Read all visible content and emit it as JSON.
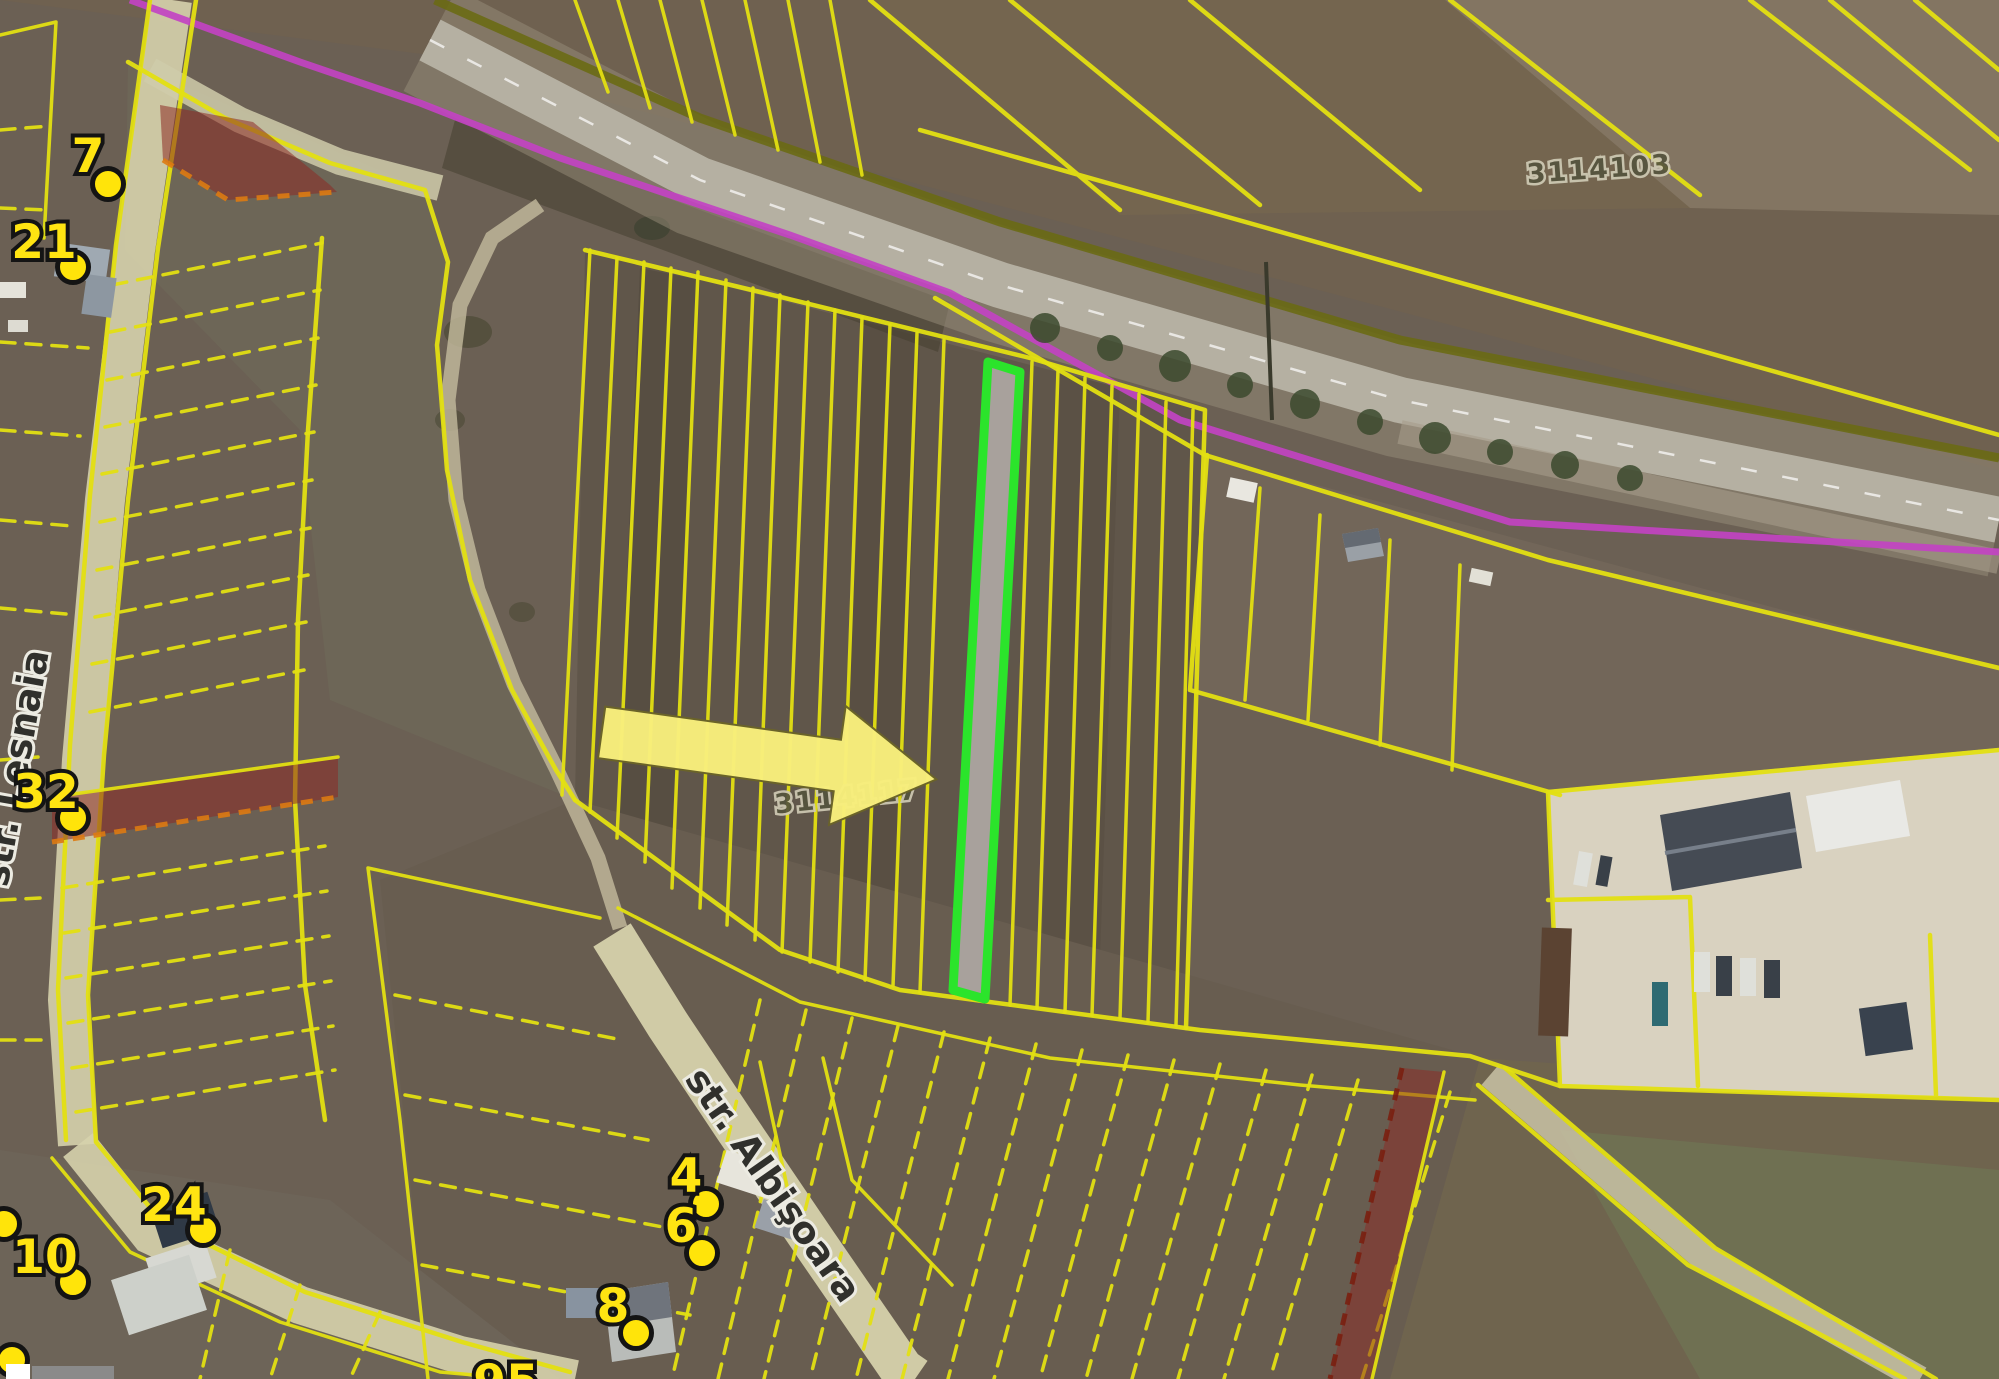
{
  "map": {
    "type": "satellite-cadastral-map",
    "parcel_labels": [
      {
        "text": "3114103",
        "x": 1600,
        "y": 178
      },
      {
        "text": "3114117",
        "x": 848,
        "y": 806
      }
    ],
    "street_labels": [
      {
        "text": "str. Lesnaia",
        "x": 28,
        "y": 770,
        "rotation": -80
      },
      {
        "text": "str. Albişoara",
        "x": 763,
        "y": 1192,
        "rotation": 55
      }
    ],
    "markers": [
      {
        "label": "7",
        "dot_x": 108,
        "dot_y": 184
      },
      {
        "label": "21",
        "dot_x": 73,
        "dot_y": 267
      },
      {
        "label": "32",
        "dot_x": 73,
        "dot_y": 818
      },
      {
        "label": "24",
        "dot_x": 203,
        "dot_y": 1230
      },
      {
        "label": "10",
        "dot_x": 73,
        "dot_y": 1282
      },
      {
        "label": "4",
        "dot_x": 706,
        "dot_y": 1204
      },
      {
        "label": "6",
        "dot_x": 702,
        "dot_y": 1253
      },
      {
        "label": "8",
        "dot_x": 636,
        "dot_y": 1333
      },
      {
        "label": "95",
        "dot_x": null,
        "dot_y": null
      }
    ],
    "highlighted_parcel": {
      "outline": "#2be42b",
      "fill": "#a8a19c"
    },
    "colors": {
      "parcel_line_yellow": "#e3df12",
      "restricted_parcel_red": "#8d2a24",
      "boundary_magenta": "#c243c2",
      "utility_line_olive": "#6a6a14",
      "arrow_yellow": "#f8ef7c",
      "marker_yellow": "#ffe412"
    }
  }
}
